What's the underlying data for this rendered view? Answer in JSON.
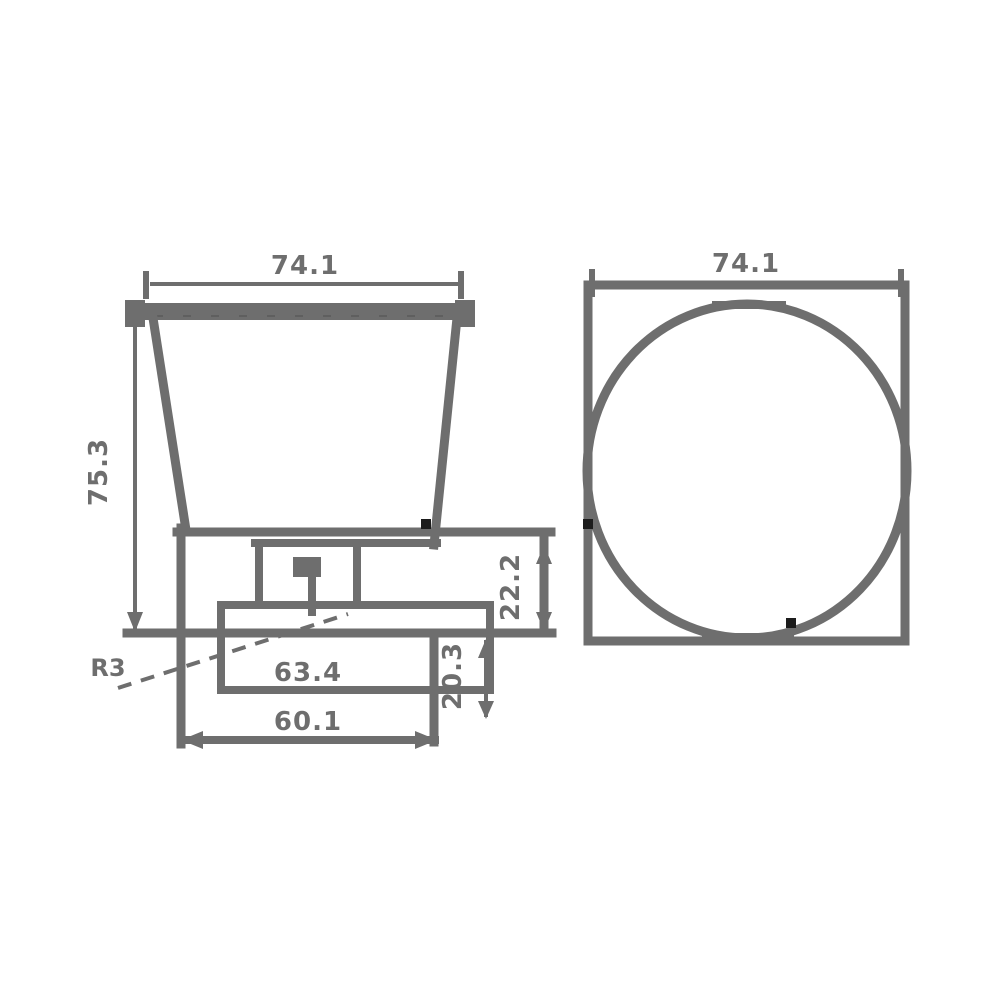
{
  "drawing": {
    "front_view": {
      "top_width": "74.1",
      "overall_height": "75.3",
      "plate_width": "63.4",
      "base_width": "60.1",
      "base_height": "22.2",
      "lower_height": "20.3",
      "radius_label": "R3"
    },
    "side_view": {
      "top_width": "74.1"
    },
    "colors": {
      "line": "#6e6e6e",
      "background": "#ffffff"
    }
  }
}
